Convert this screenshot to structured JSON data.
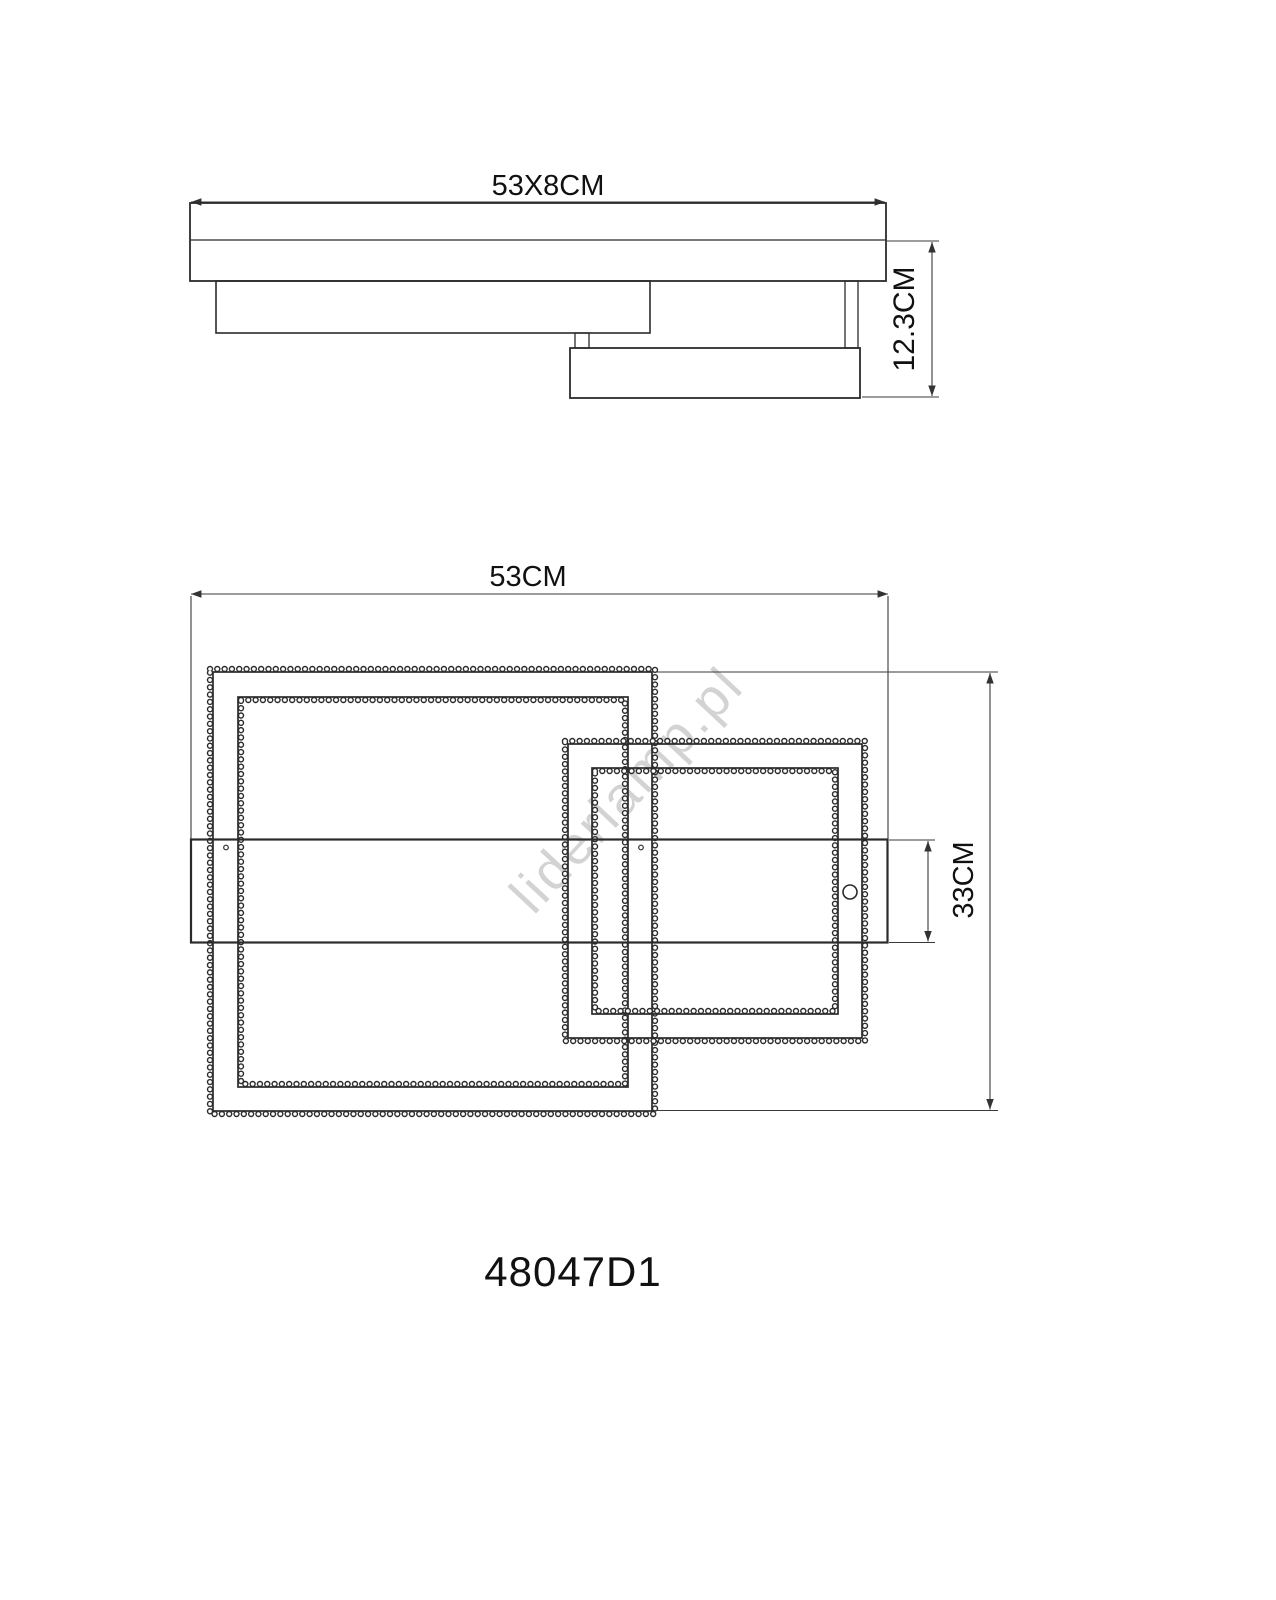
{
  "colors": {
    "background": "#ffffff",
    "line": "#2b2b2b",
    "dimension": "#3a3a3a",
    "watermark": "#c9c9c9"
  },
  "side_view": {
    "width_label": "53X8CM",
    "height_label": "12.3CM"
  },
  "plan_view": {
    "width_label": "53CM",
    "height_label": "33CM"
  },
  "product_code": "48047D1",
  "watermark": "liderlamp.pl"
}
